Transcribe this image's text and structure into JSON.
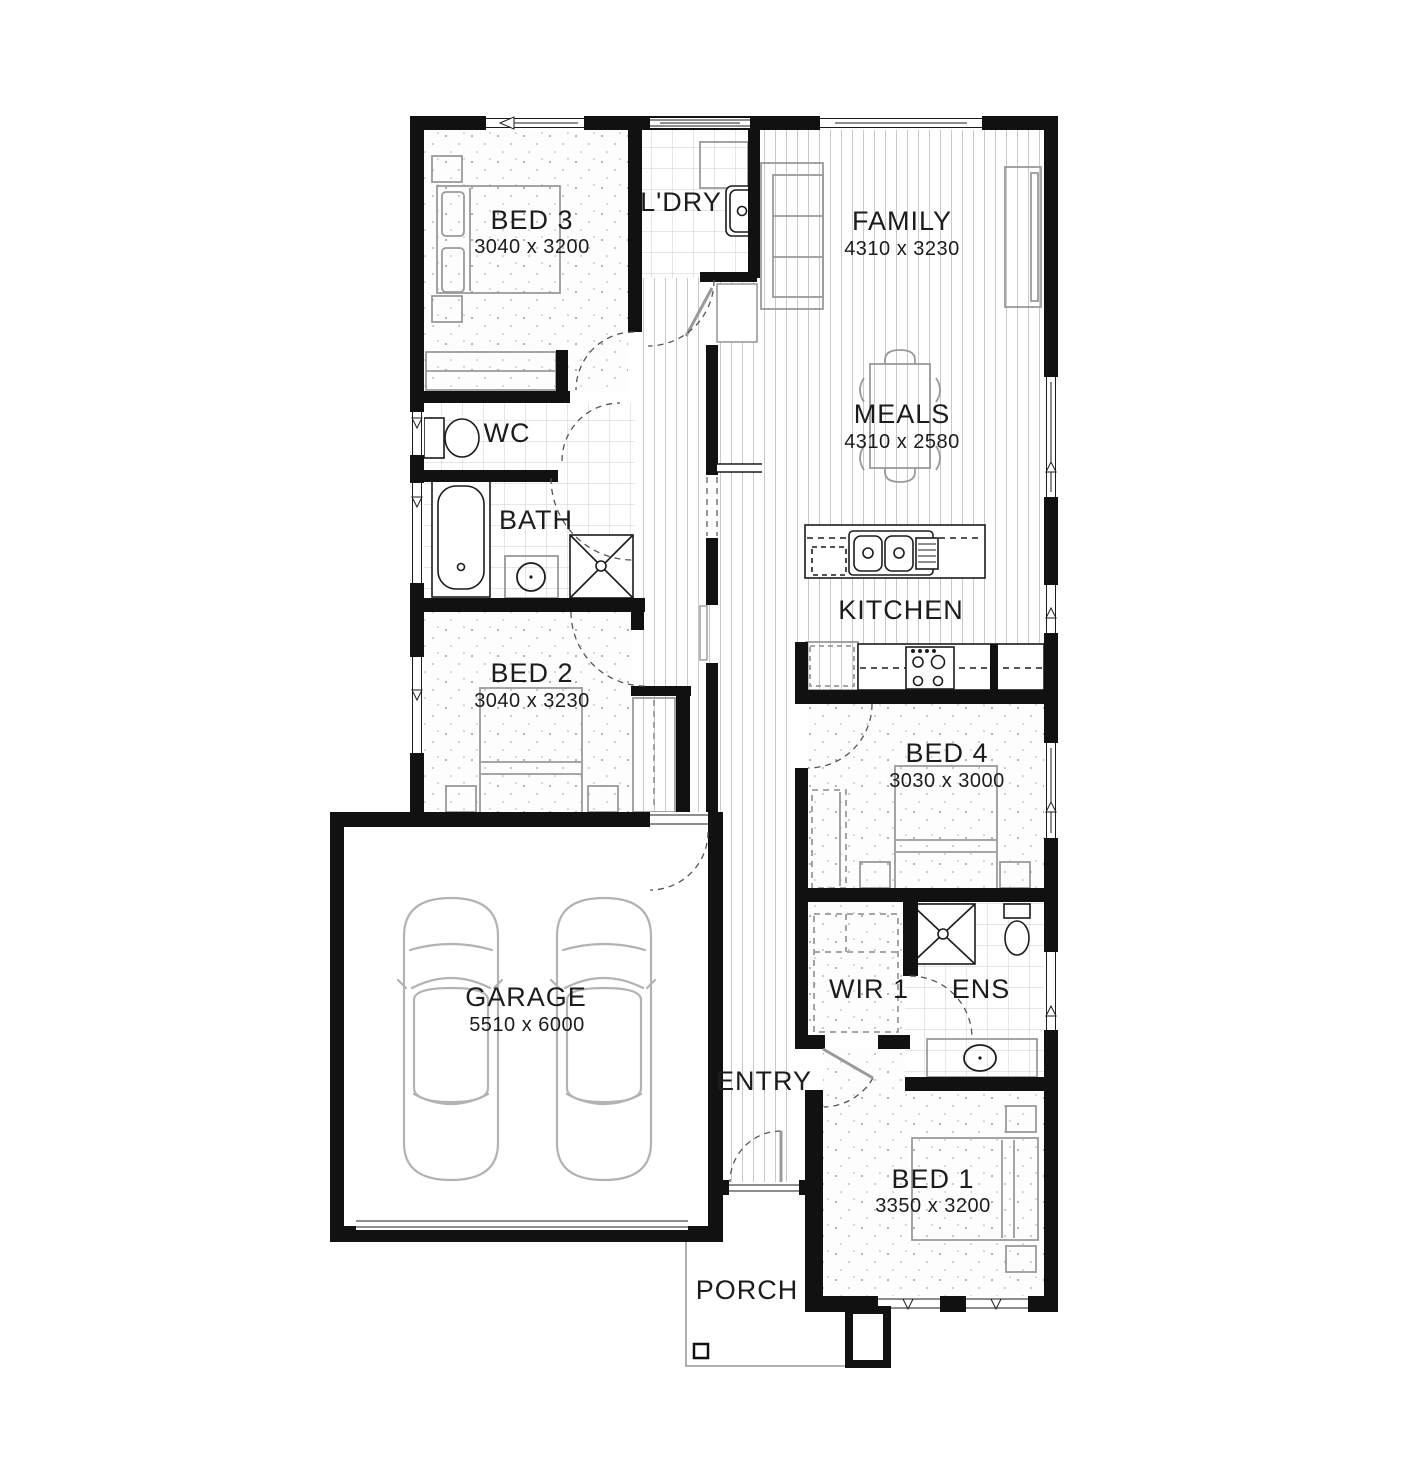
{
  "plan": {
    "type": "residential-floor-plan",
    "colors": {
      "wall": "#111111",
      "fixture_line": "#1c1c1c",
      "furniture_line": "#9a9a9a",
      "texture_line": "#cccccc",
      "background": "#ffffff",
      "text": "#1c1c1c"
    }
  },
  "rooms": [
    {
      "name": "BED 3",
      "dims": "3040 x 3200"
    },
    {
      "name": "L'DRY",
      "dims": ""
    },
    {
      "name": "FAMILY",
      "dims": "4310 x 3230"
    },
    {
      "name": "MEALS",
      "dims": "4310 x 2580"
    },
    {
      "name": "WC",
      "dims": ""
    },
    {
      "name": "BATH",
      "dims": ""
    },
    {
      "name": "KITCHEN",
      "dims": ""
    },
    {
      "name": "BED 2",
      "dims": "3040 x 3230"
    },
    {
      "name": "BED 4",
      "dims": "3030 x 3000"
    },
    {
      "name": "GARAGE",
      "dims": "5510 x 6000"
    },
    {
      "name": "WIR 1",
      "dims": ""
    },
    {
      "name": "ENS",
      "dims": ""
    },
    {
      "name": "ENTRY",
      "dims": ""
    },
    {
      "name": "BED 1",
      "dims": "3350 x 3200"
    },
    {
      "name": "PORCH",
      "dims": ""
    }
  ]
}
